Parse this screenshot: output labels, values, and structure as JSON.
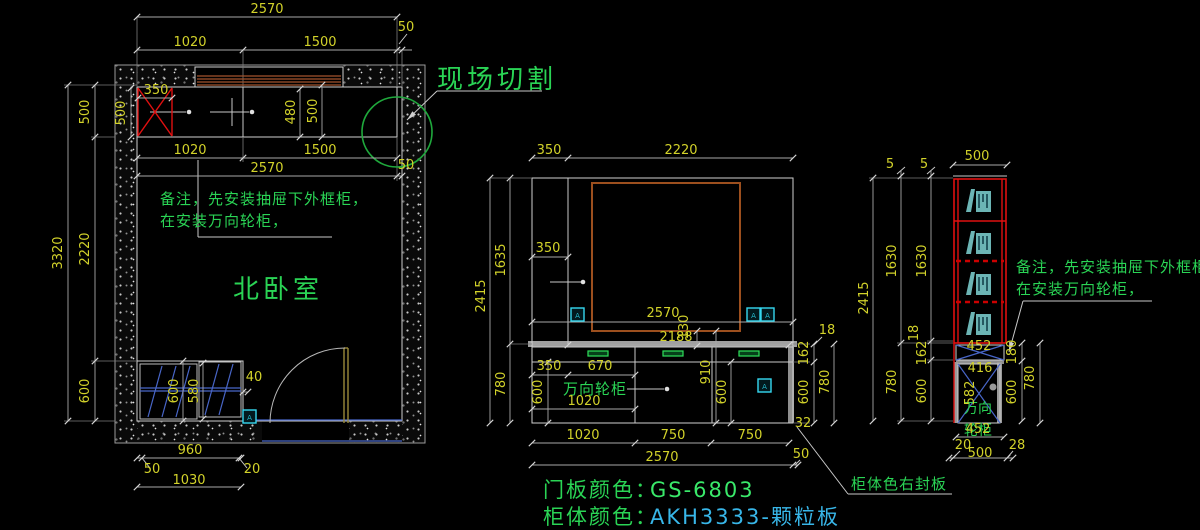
{
  "title": "北卧室柜体CAD施工图",
  "colors": {
    "background": "#000000",
    "dim_text": "#d2d22a",
    "line": "#c9c9c9",
    "annotation_green": "#2ad455",
    "value_cyan": "#38b6e8",
    "red": "#e01010",
    "brown": "#a2542c",
    "blue": "#4866c8",
    "teal": "#6cb5b5",
    "marker_cyan": "#35d8f0",
    "circle_green": "#1fa83c",
    "countertop_gray": "#a0a0a0",
    "door_olive": "#9a8a3a"
  },
  "annotations": {
    "field_cut": "现场切割",
    "room": "北卧室",
    "note1": "备注，先安装抽屉下外框柜，",
    "note2": "在安装万向轮柜，",
    "caster": "万向轮柜",
    "caster_l1": "万向",
    "caster_l2": "轮柜",
    "seal": "柜体色右封板",
    "door_color_label": "门板颜色：",
    "door_color_value": "GS-6803",
    "body_color_label": "柜体颜色：",
    "body_color_value": "AKH3333-颗粒板",
    "marker": "A"
  },
  "dim_labels": {
    "plan": [
      {
        "t": "2570",
        "x": 267,
        "y": 13
      },
      {
        "t": "1020",
        "x": 190,
        "y": 46
      },
      {
        "t": "1500",
        "x": 320,
        "y": 46
      },
      {
        "t": "50",
        "x": 406,
        "y": 31
      },
      {
        "t": "350",
        "x": 156,
        "y": 94
      },
      {
        "t": "500",
        "x": 89,
        "y": 112,
        "r": 1
      },
      {
        "t": "500",
        "x": 125,
        "y": 113,
        "r": 1
      },
      {
        "t": "480",
        "x": 295,
        "y": 112,
        "r": 1
      },
      {
        "t": "500",
        "x": 317,
        "y": 111,
        "r": 1
      },
      {
        "t": "1020",
        "x": 190,
        "y": 154
      },
      {
        "t": "1500",
        "x": 320,
        "y": 154
      },
      {
        "t": "2570",
        "x": 267,
        "y": 172
      },
      {
        "t": "50",
        "x": 406,
        "y": 169
      },
      {
        "t": "3320",
        "x": 62,
        "y": 253,
        "r": 1
      },
      {
        "t": "2220",
        "x": 89,
        "y": 249,
        "r": 1
      },
      {
        "t": "600",
        "x": 89,
        "y": 391,
        "r": 1
      },
      {
        "t": "600",
        "x": 178,
        "y": 391,
        "r": 1
      },
      {
        "t": "580",
        "x": 198,
        "y": 391,
        "r": 1
      },
      {
        "t": "40",
        "x": 254,
        "y": 381
      },
      {
        "t": "960",
        "x": 190,
        "y": 454
      },
      {
        "t": "50",
        "x": 152,
        "y": 473
      },
      {
        "t": "20",
        "x": 252,
        "y": 473
      },
      {
        "t": "1030",
        "x": 189,
        "y": 484
      }
    ],
    "elevation": [
      {
        "t": "350",
        "x": 549,
        "y": 154
      },
      {
        "t": "2220",
        "x": 681,
        "y": 154
      },
      {
        "t": "2415",
        "x": 485,
        "y": 296,
        "r": 1
      },
      {
        "t": "1635",
        "x": 505,
        "y": 260,
        "r": 1
      },
      {
        "t": "780",
        "x": 505,
        "y": 384,
        "r": 1
      },
      {
        "t": "350",
        "x": 548,
        "y": 252
      },
      {
        "t": "2570",
        "x": 663,
        "y": 317
      },
      {
        "t": "130",
        "x": 688,
        "y": 327,
        "r": 1
      },
      {
        "t": "2188",
        "x": 676,
        "y": 341
      },
      {
        "t": "350",
        "x": 549,
        "y": 370
      },
      {
        "t": "670",
        "x": 600,
        "y": 370
      },
      {
        "t": "910",
        "x": 710,
        "y": 372,
        "r": 1
      },
      {
        "t": "600",
        "x": 542,
        "y": 392,
        "r": 1
      },
      {
        "t": "600",
        "x": 726,
        "y": 392,
        "r": 1
      },
      {
        "t": "1020",
        "x": 584,
        "y": 405
      },
      {
        "t": "18",
        "x": 827,
        "y": 334
      },
      {
        "t": "162",
        "x": 808,
        "y": 353,
        "r": 1
      },
      {
        "t": "780",
        "x": 829,
        "y": 382,
        "r": 1
      },
      {
        "t": "600",
        "x": 808,
        "y": 392,
        "r": 1
      },
      {
        "t": "32",
        "x": 803,
        "y": 427
      },
      {
        "t": "1020",
        "x": 583,
        "y": 439
      },
      {
        "t": "750",
        "x": 673,
        "y": 439
      },
      {
        "t": "750",
        "x": 750,
        "y": 439
      },
      {
        "t": "2570",
        "x": 662,
        "y": 461
      },
      {
        "t": "50",
        "x": 801,
        "y": 458
      }
    ],
    "side": [
      {
        "t": "500",
        "x": 977,
        "y": 160
      },
      {
        "t": "5",
        "x": 890,
        "y": 168
      },
      {
        "t": "5",
        "x": 924,
        "y": 168
      },
      {
        "t": "2415",
        "x": 868,
        "y": 298,
        "r": 1
      },
      {
        "t": "1630",
        "x": 896,
        "y": 261,
        "r": 1
      },
      {
        "t": "1630",
        "x": 926,
        "y": 261,
        "r": 1
      },
      {
        "t": "18",
        "x": 918,
        "y": 333,
        "r": 1
      },
      {
        "t": "162",
        "x": 926,
        "y": 353,
        "r": 1
      },
      {
        "t": "780",
        "x": 896,
        "y": 382,
        "r": 1
      },
      {
        "t": "600",
        "x": 926,
        "y": 391,
        "r": 1
      },
      {
        "t": "452",
        "x": 979,
        "y": 350
      },
      {
        "t": "416",
        "x": 980,
        "y": 372
      },
      {
        "t": "582",
        "x": 974,
        "y": 393,
        "r": 1
      },
      {
        "t": "180",
        "x": 1016,
        "y": 352,
        "r": 1
      },
      {
        "t": "600",
        "x": 1016,
        "y": 392,
        "r": 1
      },
      {
        "t": "780",
        "x": 1034,
        "y": 378,
        "r": 1
      },
      {
        "t": "452",
        "x": 978,
        "y": 433
      },
      {
        "t": "20",
        "x": 963,
        "y": 449
      },
      {
        "t": "500",
        "x": 980,
        "y": 457
      },
      {
        "t": "28",
        "x": 1017,
        "y": 449
      }
    ]
  }
}
